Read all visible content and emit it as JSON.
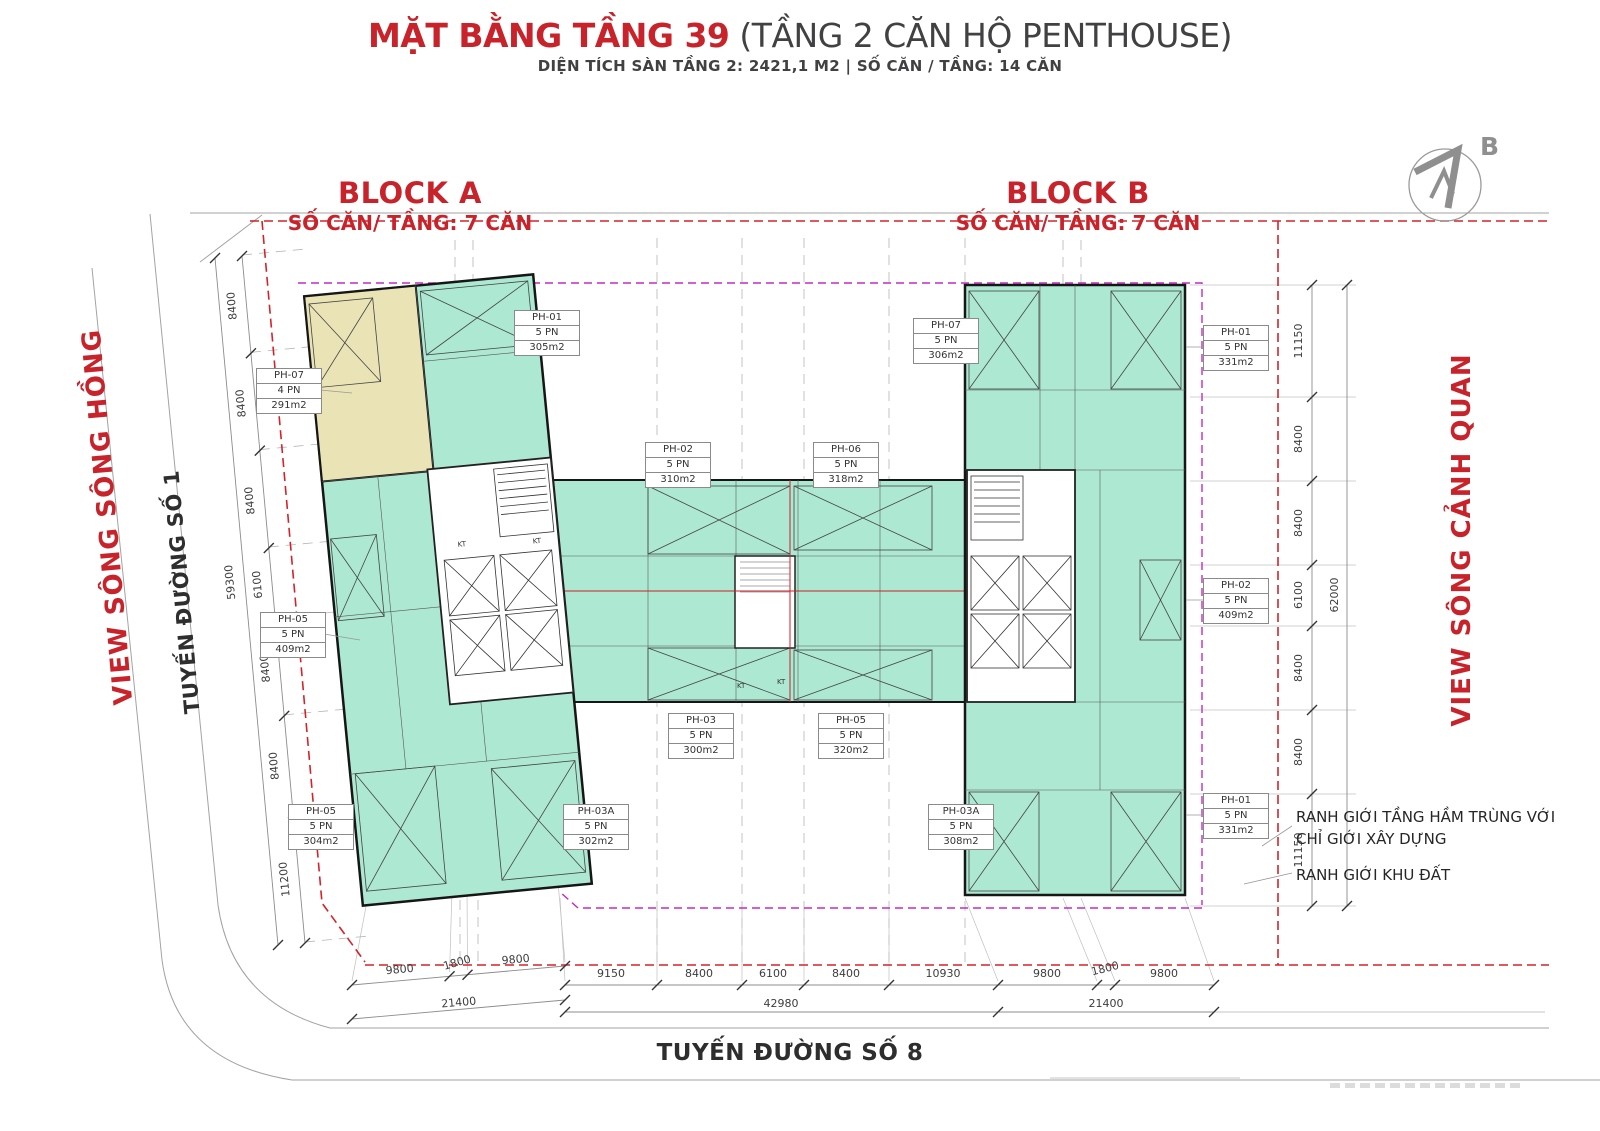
{
  "header": {
    "title_main": "MẶT BẰNG TẦNG 39",
    "title_sub": "(TẦNG 2 CĂN HỘ PENTHOUSE)",
    "subtitle": "DIỆN TÍCH SÀN TẦNG 2: 2421,1 M2 | SỐ CĂN / TẦNG: 14 CĂN"
  },
  "compass": {
    "label": "B"
  },
  "blocks": {
    "a": {
      "name": "BLOCK A",
      "units_per_floor": "SỐ CĂN/ TẦNG: 7 CĂN"
    },
    "b": {
      "name": "BLOCK B",
      "units_per_floor": "SỐ CĂN/ TẦNG: 7 CĂN"
    }
  },
  "streets": {
    "left_view": "VIEW SÔNG SÔNG HỒNG",
    "left_road": "TUYẾN ĐƯỜNG SỐ 1",
    "right_view": "VIEW SÔNG CẢNH QUAN",
    "bottom_road": "TUYẾN ĐƯỜNG SỐ 8"
  },
  "legend_notes": {
    "note1": "RANH GIỚI TẦNG HẦM TRÙNG VỚI CHỈ GIỚI XÂY DỰNG",
    "note2": "RANH GIỚI KHU ĐẤT"
  },
  "shaft_labels": {
    "kt": "KT"
  },
  "units": [
    {
      "code": "PH-07",
      "bedrooms": "4 PN",
      "area": "291m2"
    },
    {
      "code": "PH-01",
      "bedrooms": "5 PN",
      "area": "305m2"
    },
    {
      "code": "PH-02",
      "bedrooms": "5 PN",
      "area": "310m2"
    },
    {
      "code": "PH-06",
      "bedrooms": "5 PN",
      "area": "318m2"
    },
    {
      "code": "PH-07",
      "bedrooms": "5 PN",
      "area": "306m2"
    },
    {
      "code": "PH-01",
      "bedrooms": "5 PN",
      "area": "331m2"
    },
    {
      "code": "PH-05",
      "bedrooms": "5 PN",
      "area": "409m2"
    },
    {
      "code": "PH-02",
      "bedrooms": "5 PN",
      "area": "409m2"
    },
    {
      "code": "PH-03",
      "bedrooms": "5 PN",
      "area": "300m2"
    },
    {
      "code": "PH-05",
      "bedrooms": "5 PN",
      "area": "320m2"
    },
    {
      "code": "PH-05",
      "bedrooms": "5 PN",
      "area": "304m2"
    },
    {
      "code": "PH-03A",
      "bedrooms": "5 PN",
      "area": "302m2"
    },
    {
      "code": "PH-03A",
      "bedrooms": "5 PN",
      "area": "308m2"
    },
    {
      "code": "PH-01",
      "bedrooms": "5 PN",
      "area": "331m2"
    }
  ],
  "dimensions": {
    "left_chain": [
      "8400",
      "8400",
      "8400",
      "6100",
      "8400",
      "8400",
      "11200"
    ],
    "left_total": "59300",
    "right_chain": [
      "11150",
      "8400",
      "8400",
      "6100",
      "8400",
      "8400",
      "11150"
    ],
    "right_total": "62000",
    "bottom_left_chain": [
      "9800",
      "1800",
      "9800"
    ],
    "bottom_left_total": "21400",
    "bottom_mid_chain": [
      "9150",
      "8400",
      "6100",
      "8400",
      "10930"
    ],
    "bottom_mid_total": "42980",
    "bottom_right_chain": [
      "9800",
      "1800",
      "9800"
    ],
    "bottom_right_total": "21400"
  },
  "colors": {
    "accent_red": "#c8232a",
    "boundary_red": "#d42328",
    "boundary_magenta": "#c32bc3",
    "apartment_green": "#ade8d3",
    "unit_beige": "#eae3b6"
  }
}
